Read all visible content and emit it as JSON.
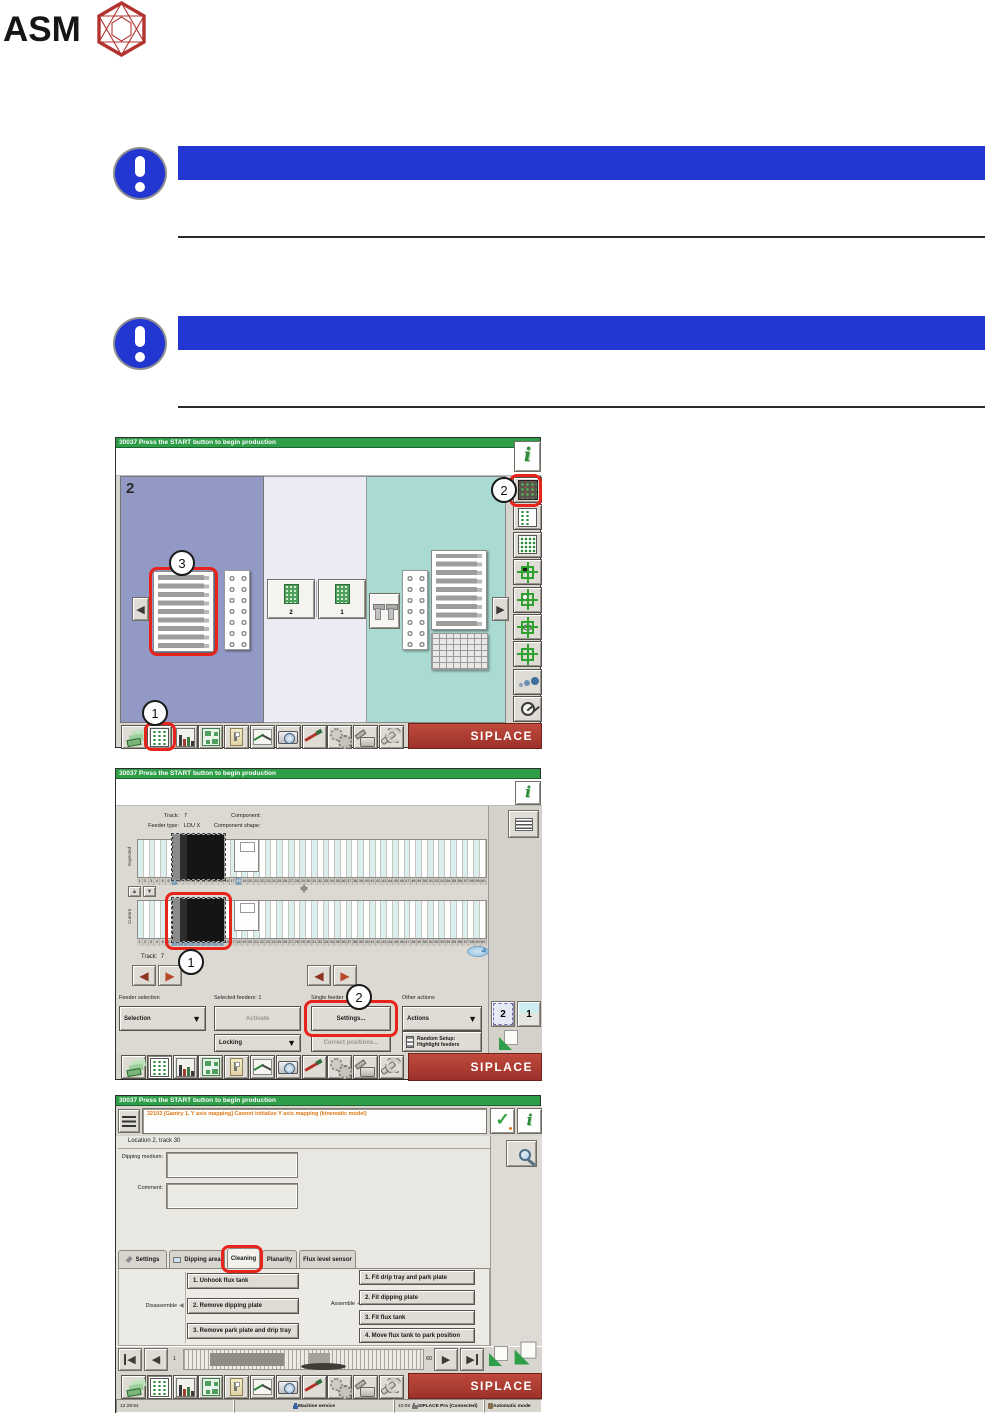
{
  "logo": {
    "text": "ASM"
  },
  "titlebar_text": "30037 Press the START button to begin production",
  "siplace_label": "SIPLACE",
  "toolbar_icons": [
    "boards-stack-icon",
    "feeder-table-icon",
    "setup-columns-icon",
    "board-view-icon",
    "component-box-icon",
    "statistics-icon",
    "camera-icon",
    "repair-pen-icon",
    "service-gears-icon",
    "oiler-icon",
    "maintenance-wrench-icon"
  ],
  "colors": {
    "title_green": "#2f9e49",
    "notice_blue": "#2236d1",
    "siplace_red": "#9c312a",
    "highlight_red": "#e8231b",
    "panel_blue": "#9199c4",
    "panel_teal": "#a9dbd3"
  },
  "screen1": {
    "gantry_label": "2",
    "chips": [
      "2",
      "1"
    ],
    "right_toolbar_icons": [
      "feeder-table-dark-icon",
      "feeder-table-mixed-icon",
      "feeder-table-full-icon",
      "pickup-dark-component-icon",
      "pickup-light-component-icon",
      "align-component-icon",
      "crosshair-icon",
      "splice-dots-icon",
      "gauge-icon"
    ],
    "callout_1": "1",
    "callout_2": "2",
    "callout_3": "3"
  },
  "screen2": {
    "labels": {
      "track": "Track:",
      "track_value": "7",
      "feeder_type": "Feeder type:",
      "feeder_type_value": "LDU X",
      "component": "Component:",
      "component_shape": "Component shape:",
      "expected": "Expected",
      "current": "Current",
      "track_bottom": "Track:",
      "track_bottom_value": "7"
    },
    "slot_count": 60,
    "marked_slots": [
      7,
      18
    ],
    "selected_slots": [
      7,
      8,
      9,
      10,
      11,
      12,
      13,
      14,
      15
    ],
    "sections": [
      "Feeder selection",
      "Selected feeders: 1",
      "Single feeder",
      "Other actions"
    ],
    "buttons": {
      "selection": "Selection",
      "activate": "Activate",
      "settings": "Settings...",
      "actions": "Actions",
      "locking": "Locking",
      "correct_positions": "Correct positions...",
      "random_setup_line1": "Random Setup:",
      "random_setup_line2": "Highlight feeders"
    },
    "gantry_buttons": [
      "2",
      "1"
    ],
    "callout_1": "1",
    "callout_2": "2"
  },
  "screen3": {
    "alarm_text": "32103 [Gantry 1, Y axis mapping] Cannot initialize Y axis mapping (kinematic model)",
    "location_text": "Location 2, track 30",
    "dipping_medium_label": "Dipping medium:",
    "comment_label": "Comment:",
    "tabs": [
      "Settings",
      "Dipping area",
      "Cleaning",
      "Planarity",
      "Flux level sensor"
    ],
    "active_tab_index": 2,
    "disassemble_label": "Disassemble",
    "disassemble_buttons": [
      "1. Unhook flux tank",
      "2. Remove dipping plate",
      "3. Remove park plate and drip tray"
    ],
    "assemble_label": "Assemble",
    "assemble_buttons": [
      "1. Fit drip tray and park plate",
      "2. Fit dipping plate",
      "3. Fit flux tank",
      "4. Move flux tank to park position"
    ],
    "nav_first": "1",
    "nav_last": "60",
    "status": {
      "time": "12:28:54",
      "machine_service": "Machine service",
      "connect_time": "10:09",
      "connection": "SIPLACE Pro (Connected)",
      "mode": "Automatic mode"
    }
  }
}
